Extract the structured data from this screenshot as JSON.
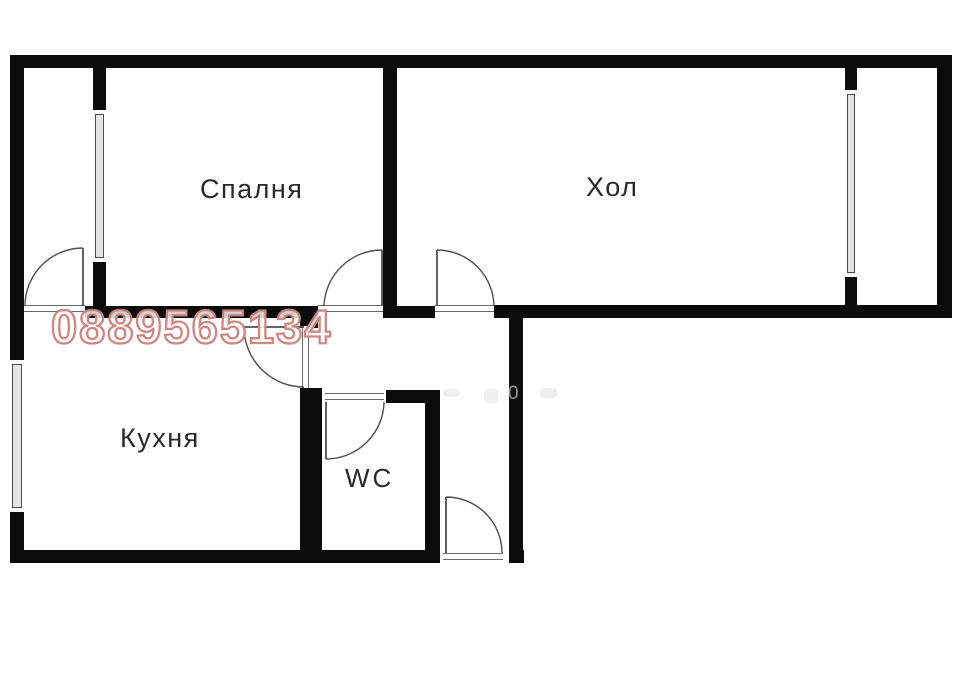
{
  "plan": {
    "type": "apartment-floor-plan",
    "rooms": [
      {
        "key": "bedroom",
        "label": "Спалня"
      },
      {
        "key": "living-room",
        "label": "Хол"
      },
      {
        "key": "kitchen",
        "label": "Кухня"
      },
      {
        "key": "wc",
        "label": "WC"
      }
    ],
    "watermark": {
      "text": "0889565134"
    },
    "faint_mark": {
      "text": "0"
    },
    "colors": {
      "wall": "#0b0b0b",
      "door_line": "#4f4f4f",
      "watermark_outline": "#c9827c",
      "label_text": "#282828",
      "window_glass": "#e4e4e4"
    },
    "features": {
      "doors": [
        "closet-door",
        "bedroom-door",
        "living-room-door",
        "kitchen-door",
        "wc-door",
        "entrance-door"
      ],
      "windows": [
        "bedroom-window",
        "kitchen-window",
        "living-room-window"
      ]
    }
  }
}
